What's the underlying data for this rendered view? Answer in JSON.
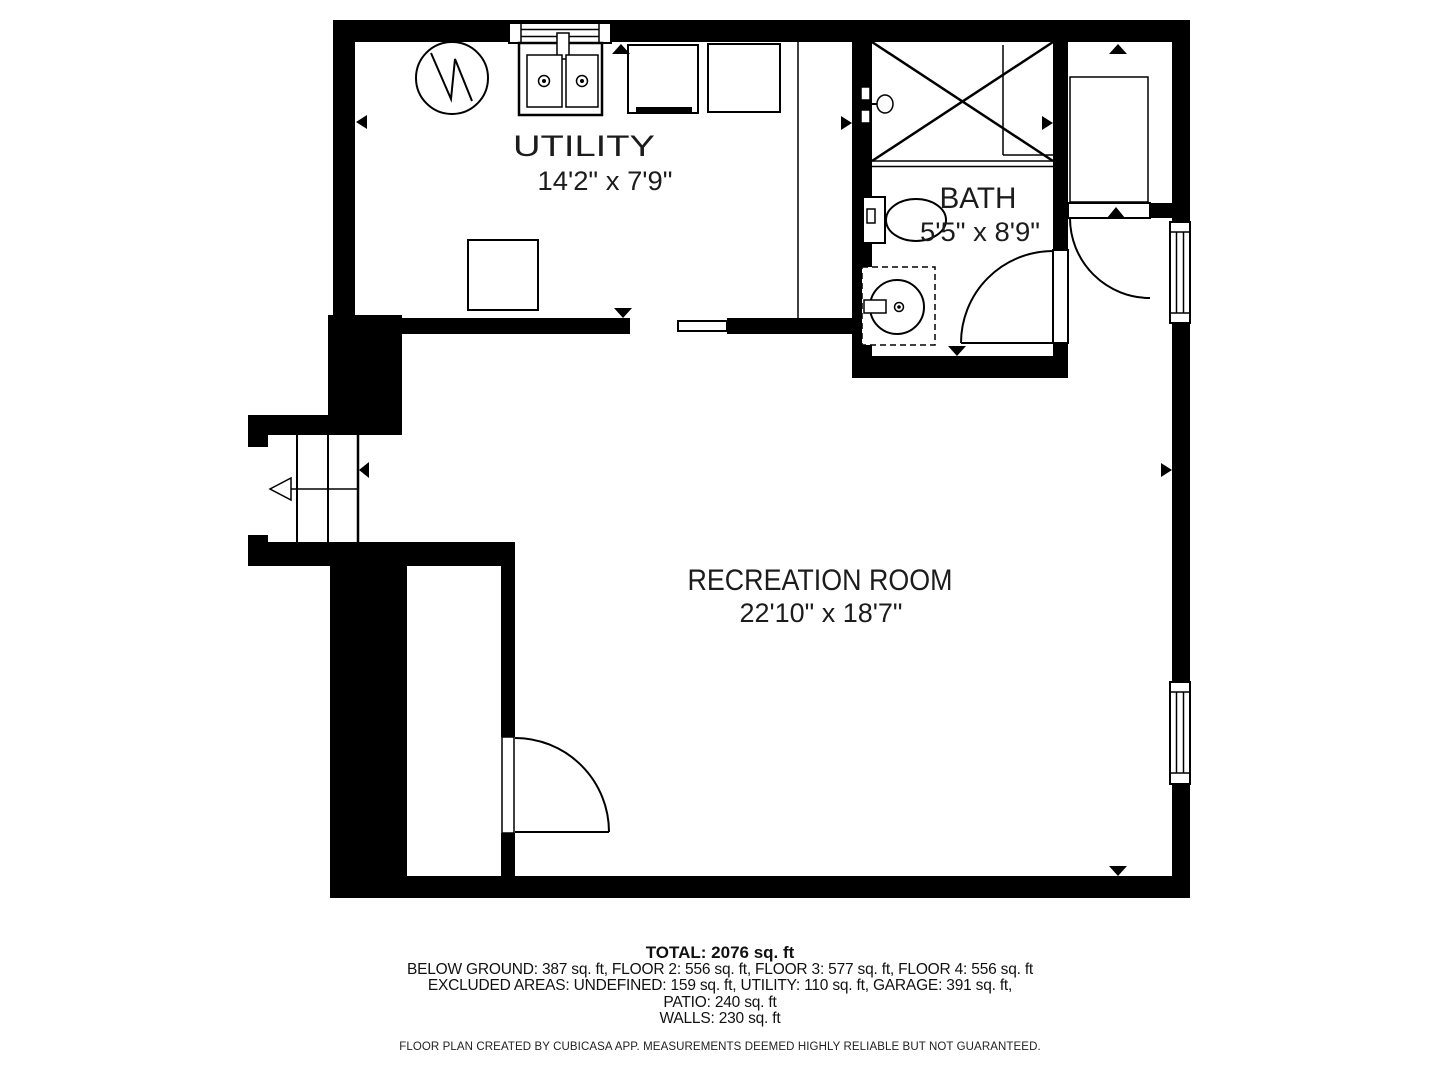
{
  "plan": {
    "rooms": [
      {
        "name": "UTILITY",
        "dims": "14'2\" x 7'9\""
      },
      {
        "name": "BATH",
        "dims": "5'5\" x 8'9\""
      },
      {
        "name": "RECREATION ROOM",
        "dims": "22'10\" x 18'7\""
      }
    ],
    "colors": {
      "wall": "#000000",
      "floor": "#ffffff"
    }
  },
  "footer": {
    "total": "TOTAL: 2076 sq. ft",
    "line1": "BELOW GROUND: 387 sq. ft, FLOOR 2: 556 sq. ft, FLOOR 3: 577 sq. ft, FLOOR 4: 556 sq. ft",
    "line2": "EXCLUDED AREAS: UNDEFINED: 159 sq. ft, UTILITY: 110 sq. ft, GARAGE: 391 sq. ft,",
    "line3": "PATIO: 240 sq. ft",
    "line4": "WALLS: 230 sq. ft",
    "disclaimer": "FLOOR PLAN CREATED BY CUBICASA APP. MEASUREMENTS DEEMED HIGHLY RELIABLE BUT NOT GUARANTEED."
  }
}
